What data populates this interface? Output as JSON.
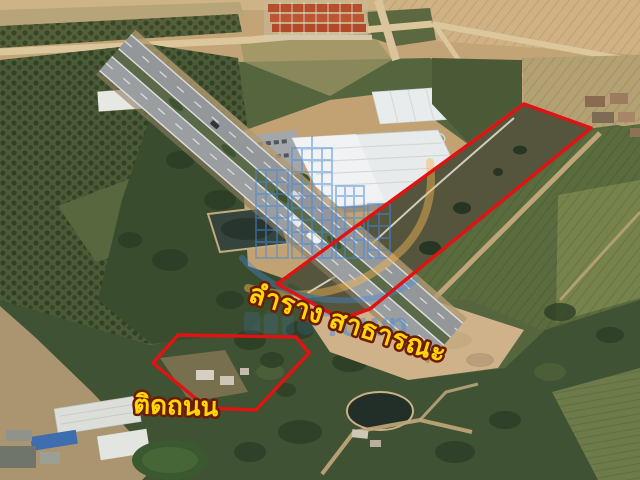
{
  "theme": {
    "boundary-red": "#e31212",
    "label-yellow": "#ffd60a",
    "label-outline": "#6d1b02",
    "watermark-blue": "#4289dc",
    "watermark-orange": "#f2b553"
  },
  "annotations": {
    "parcels": [
      {
        "id": "main-parcel",
        "points": "524,104 591,128 370,309 341,319 277,284"
      },
      {
        "id": "road-front-parcel",
        "points": "153,363 178,335 296,337 309,353 256,410 207,408"
      }
    ],
    "labels": {
      "canal": "ลำราง สาธารณะ",
      "road_front": "ติดถนน"
    },
    "watermark": {
      "text": "Town",
      "logo": "city-skyline-logo"
    }
  }
}
